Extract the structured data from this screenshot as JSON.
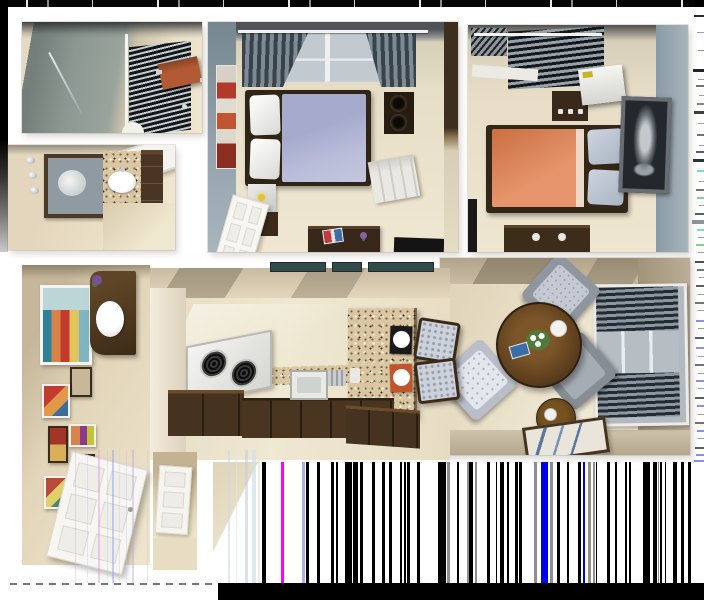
{
  "scene": {
    "title": "3D rendered top-down floor plan of a one-bedroom-plus-den apartment with rendering glitch artifacts",
    "background": "#ffffff"
  },
  "rooms": {
    "closet": {
      "name": "Walk-in closet with slatted blinds and orange shelf"
    },
    "bathroom": {
      "name": "Bathroom with vanity, mirror and tub"
    },
    "bedroom1": {
      "name": "Bedroom with lavender bed"
    },
    "bedroom2": {
      "name": "Bedroom with orange bed"
    },
    "living": {
      "name": "Living room with armchairs and round table"
    },
    "kitchen": {
      "name": "Kitchen with granite breakfast bar"
    },
    "hallway": {
      "name": "Entry hallway with gallery wall"
    },
    "entry": {
      "name": "Entry closet"
    }
  },
  "palette": {
    "lavender_duvet": "#a6abce",
    "orange_duvet": "#e07c4a",
    "orange_shelf": "#b25a33",
    "gray_blue_wall": "#93a4ae",
    "sage_wall": "#8d9892",
    "taupe_wall": "#b3a691",
    "floor_beige": "#e8dfc8",
    "wood_dark": "#46331f",
    "granite": "#d9c6a2",
    "placemat_black": "#1a1a1a",
    "placemat_orange": "#c2542c",
    "transom_teal": "#324a4a",
    "glitch_black": "#000000"
  },
  "glitch": {
    "barcode": {
      "x": 256,
      "y": 462,
      "w": 448,
      "h": 121,
      "colors": {
        "k": "#000000",
        "m": "#ff00ff",
        "p": "#a9aefc",
        "g": "#8e8e8e",
        "b": "#0000ef"
      },
      "bars": [
        [
          262,
          4,
          "k"
        ],
        [
          281,
          3,
          "m"
        ],
        [
          302,
          3,
          "p"
        ],
        [
          306,
          3,
          "k"
        ],
        [
          317,
          3,
          "k"
        ],
        [
          331,
          3,
          "k"
        ],
        [
          336,
          2,
          "k"
        ],
        [
          345,
          7,
          "k"
        ],
        [
          353,
          5,
          "k"
        ],
        [
          360,
          3,
          "k"
        ],
        [
          372,
          3,
          "k"
        ],
        [
          382,
          3,
          "k"
        ],
        [
          389,
          3,
          "k"
        ],
        [
          400,
          2,
          "k"
        ],
        [
          404,
          2,
          "k"
        ],
        [
          407,
          3,
          "k"
        ],
        [
          417,
          3,
          "k"
        ],
        [
          438,
          8,
          "k"
        ],
        [
          447,
          3,
          "g"
        ],
        [
          457,
          2,
          "k"
        ],
        [
          467,
          2,
          "g"
        ],
        [
          469,
          4,
          "k"
        ],
        [
          475,
          2,
          "g"
        ],
        [
          487,
          3,
          "k"
        ],
        [
          496,
          1,
          "k"
        ],
        [
          500,
          4,
          "k"
        ],
        [
          507,
          2,
          "k"
        ],
        [
          515,
          3,
          "k"
        ],
        [
          519,
          3,
          "k"
        ],
        [
          534,
          3,
          "g"
        ],
        [
          541,
          7,
          "b"
        ],
        [
          550,
          3,
          "g"
        ],
        [
          557,
          3,
          "k"
        ],
        [
          567,
          2,
          "k"
        ],
        [
          578,
          3,
          "k"
        ],
        [
          583,
          2,
          "b"
        ],
        [
          588,
          3,
          "g"
        ],
        [
          593,
          2,
          "g"
        ],
        [
          596,
          1,
          "k"
        ],
        [
          607,
          3,
          "k"
        ],
        [
          615,
          2,
          "k"
        ],
        [
          625,
          2,
          "k"
        ],
        [
          629,
          2,
          "k"
        ],
        [
          643,
          7,
          "k"
        ],
        [
          653,
          4,
          "k"
        ],
        [
          658,
          1,
          "g"
        ],
        [
          660,
          2,
          "k"
        ],
        [
          665,
          1,
          "k"
        ],
        [
          673,
          4,
          "k"
        ],
        [
          681,
          3,
          "k"
        ],
        [
          688,
          3,
          "k"
        ]
      ]
    },
    "right_dashes": [
      [
        8,
        10,
        2,
        "#2a2a2a"
      ],
      [
        25,
        7,
        1,
        "#9aa0a4"
      ],
      [
        43,
        6,
        1,
        "#8b9195"
      ],
      [
        62,
        11,
        3,
        "#1f2326"
      ],
      [
        72,
        6,
        1,
        "#9aa0a4"
      ],
      [
        78,
        8,
        2,
        "#707678"
      ],
      [
        88,
        5,
        1,
        "#9aa0a4"
      ],
      [
        96,
        7,
        2,
        "#83898c"
      ],
      [
        104,
        10,
        3,
        "#3a4043"
      ],
      [
        116,
        6,
        1,
        "#9aa0a4"
      ],
      [
        127,
        7,
        2,
        "#6f7578"
      ],
      [
        138,
        5,
        1,
        "#9aa0a4"
      ],
      [
        144,
        8,
        2,
        "#595f62"
      ],
      [
        152,
        11,
        3,
        "#2e3336"
      ],
      [
        163,
        7,
        2,
        "#7fd8cf"
      ],
      [
        174,
        5,
        1,
        "#9aa0a4"
      ],
      [
        182,
        8,
        2,
        "#6f7578"
      ],
      [
        190,
        7,
        2,
        "#86d08e"
      ],
      [
        198,
        5,
        1,
        "#9aa0a4"
      ],
      [
        206,
        9,
        2,
        "#595f62"
      ],
      [
        213,
        12,
        4,
        "#8e9496"
      ],
      [
        222,
        7,
        2,
        "#7fd8cf"
      ],
      [
        230,
        6,
        1,
        "#9aa0a4"
      ],
      [
        237,
        8,
        2,
        "#86d08e"
      ],
      [
        245,
        6,
        1,
        "#9aa0a4"
      ],
      [
        254,
        9,
        2,
        "#4a5053"
      ],
      [
        262,
        7,
        2,
        "#6f7578"
      ],
      [
        270,
        5,
        1,
        "#9aa0a4"
      ],
      [
        278,
        8,
        2,
        "#595f62"
      ],
      [
        287,
        6,
        1,
        "#9aa0a4"
      ],
      [
        295,
        9,
        2,
        "#6f7578"
      ],
      [
        303,
        6,
        1,
        "#9aa0a4"
      ],
      [
        313,
        8,
        2,
        "#8890e8"
      ],
      [
        321,
        6,
        1,
        "#9aa0a4"
      ],
      [
        330,
        9,
        2,
        "#595f62"
      ],
      [
        340,
        8,
        2,
        "#8890e8"
      ],
      [
        349,
        6,
        1,
        "#9aa0a4"
      ],
      [
        357,
        9,
        2,
        "#6f7578"
      ],
      [
        366,
        6,
        1,
        "#9aa0a4"
      ],
      [
        373,
        8,
        2,
        "#8890e8"
      ],
      [
        381,
        6,
        1,
        "#9aa0a4"
      ],
      [
        390,
        9,
        2,
        "#595f62"
      ],
      [
        398,
        7,
        2,
        "#8890e8"
      ],
      [
        407,
        6,
        1,
        "#9aa0a4"
      ],
      [
        415,
        9,
        2,
        "#6f7578"
      ],
      [
        423,
        7,
        2,
        "#8890e8"
      ],
      [
        431,
        6,
        1,
        "#9aa0a4"
      ],
      [
        440,
        9,
        2,
        "#595f62"
      ],
      [
        447,
        8,
        2,
        "#8890e8"
      ],
      [
        453,
        10,
        3,
        "#8892e0"
      ]
    ],
    "faint_stripes": [
      [
        75,
        1,
        "#cbb8d8",
        0.45
      ],
      [
        87,
        1,
        "#d4c4e4",
        0.4
      ],
      [
        98,
        2,
        "#e39be3",
        0.5
      ],
      [
        107,
        1,
        "#b9c6ea",
        0.4
      ],
      [
        112,
        2,
        "#93a3ea",
        0.5
      ],
      [
        119,
        1,
        "#c6cde8",
        0.4
      ],
      [
        126,
        1,
        "#cfc6ea",
        0.4
      ],
      [
        132,
        2,
        "#b9a8de",
        0.45
      ],
      [
        147,
        1,
        "#c9c9c9",
        0.4
      ],
      [
        228,
        2,
        "#cdd9ea",
        0.6
      ],
      [
        236,
        1,
        "#dfe5ef",
        0.6
      ],
      [
        245,
        3,
        "#c3cfdd",
        0.6
      ],
      [
        252,
        4,
        "#cfdfea",
        0.7
      ],
      [
        258,
        2,
        "#eee8c9",
        0.8
      ]
    ]
  }
}
